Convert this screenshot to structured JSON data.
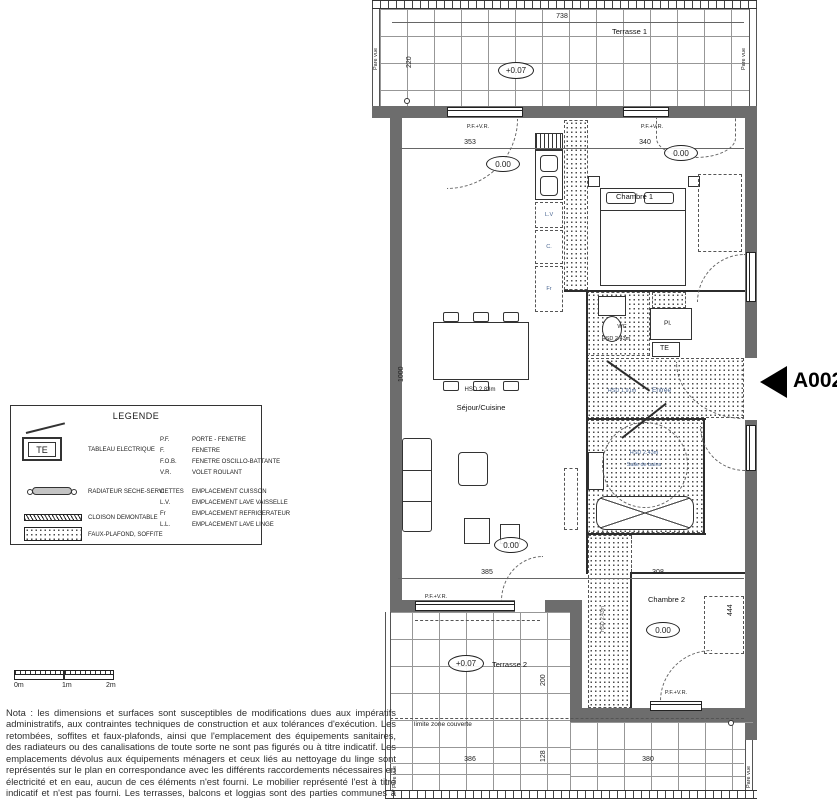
{
  "unit": {
    "code": "A002"
  },
  "levels": {
    "terrace": "+0.07",
    "floor": "0.00"
  },
  "common": {
    "pfvr": "P.F.+V.R.",
    "pare_vue": "Pare vue",
    "limite": "limite zone couverte"
  },
  "terrace1": {
    "name": "Terrasse 1",
    "dim_width": "738",
    "dim_depth": "220"
  },
  "terrace2": {
    "name": "Terrasse 2",
    "dim_depth": "200",
    "dim_a": "386",
    "dim_b": "380",
    "dim_c": "128"
  },
  "sejour": {
    "name": "Séjour/Cuisine",
    "hsd": "HSD 2.83m",
    "dim_window": "353",
    "dim_depth": "1000",
    "dim_window_bottom": "385"
  },
  "kitchen": {
    "lv": "L.V",
    "c": "C.",
    "fr": "Fr"
  },
  "chambre1": {
    "name": "Chambre 1",
    "dim_window": "340"
  },
  "chambre2": {
    "name": "Chambre 2",
    "dim_width": "308",
    "dim_depth": "444"
  },
  "wc": {
    "name": "WC",
    "hsd": "HSD 2.43m"
  },
  "bain": {
    "name": "Salle de bains",
    "hsd": "HSD 2.43m"
  },
  "entree": {
    "name": "Entrée",
    "hsd": "HSD 1.91m"
  },
  "rangement": {
    "pl": "Pl.",
    "te": "TE"
  },
  "soffite_strip": {
    "hsd": "HSD 2.43m"
  },
  "scale_bar": {
    "m0": "0m",
    "m1": "1m",
    "m2": "2m"
  },
  "legend": {
    "title": "LEGENDE",
    "te_symbol": "TE",
    "symbols": [
      "TABLEAU ELECTRIQUE",
      "RADIATEUR SECHE-SERVIETTES",
      "CLOISON DEMONTABLE",
      "FAUX-PLAFOND, SOFFITE"
    ],
    "abbreviations": [
      {
        "abbr": "P.F.",
        "label": "PORTE - FENETRE"
      },
      {
        "abbr": "F.",
        "label": "FENETRE"
      },
      {
        "abbr": "F.O.B.",
        "label": "FENETRE OSCILLO-BATTANTE"
      },
      {
        "abbr": "V.R.",
        "label": "VOLET ROULANT"
      },
      {
        "abbr": "C.",
        "label": "EMPLACEMENT CUISSON"
      },
      {
        "abbr": "L.V.",
        "label": "EMPLACEMENT LAVE VAISSELLE"
      },
      {
        "abbr": "Fr",
        "label": "EMPLACEMENT REFRIGERATEUR"
      },
      {
        "abbr": "L.L.",
        "label": "EMPLACEMENT LAVE LINGE"
      }
    ]
  },
  "nota": {
    "text": "Nota : les dimensions et surfaces sont susceptibles de modifications dues aux impératifs administratifs, aux contraintes techniques de construction et aux tolérances d'exécution. Les retombées, soffites et faux-plafonds, ainsi que l'emplacement des équipements sanitaires, des radiateurs ou des canalisations de toute sorte ne sont pas figurés ou à titre indicatif. Les emplacements dévolus aux équipements ménagers et ceux liés au nettoyage du linge sont représentés sur le plan en correspondance avec les différents raccordements nécessaires en électricité et en eau, aucun de ces éléments n'est fourni. Le mobilier représenté l'est à titre indicatif et n'est pas fourni. Les terrasses, balcons et loggias sont des parties communes à jouissance privative."
  },
  "colors": {
    "wall": "#6d6d6d",
    "line": "#2c2c2c",
    "accent_text": "#44618e"
  }
}
